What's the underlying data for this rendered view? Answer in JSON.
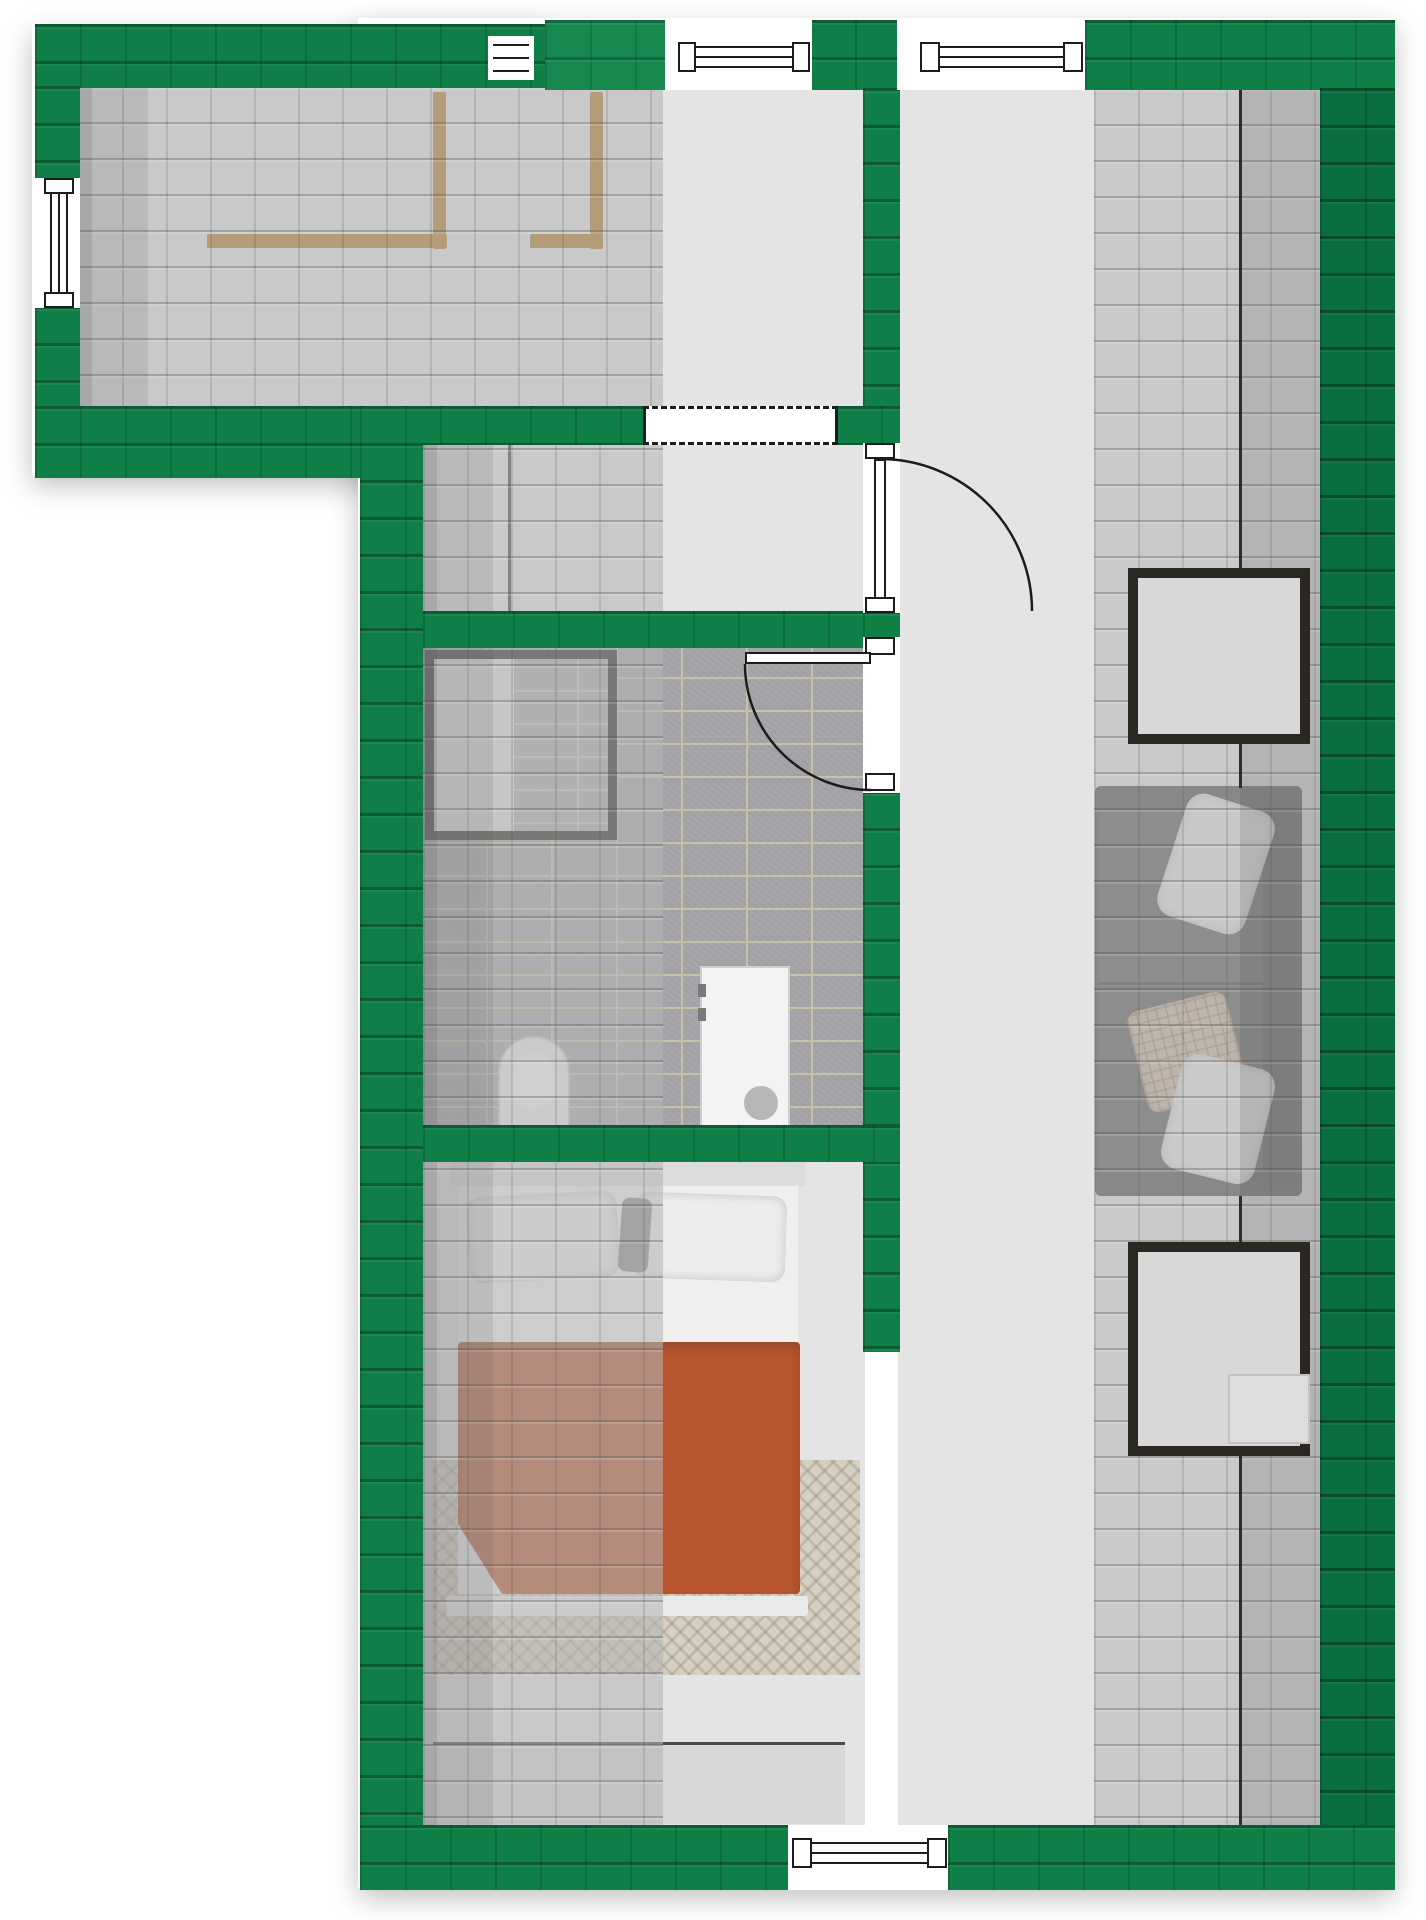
{
  "meta": {
    "type": "architectural-floor-plan",
    "view": "top-down attic storey with semi-transparent roof",
    "storey": "attic"
  },
  "palette": {
    "bg": "#ffffff",
    "roof-green": "#0f7f47",
    "roof-green-dark": "#0b6e3e",
    "roof-green-light": "#17894f",
    "floor": "#e4e4e4",
    "bath-tile": "#a2a2a6",
    "grout": "#c8c0a8",
    "wood": "#b07a28",
    "frame-dark": "#2b2824",
    "sofa": "#4b4b4b",
    "sofa-seat": "#565656",
    "blanket": "#b6552e",
    "rug": "#d6d0c2",
    "line": "#1c1c1c",
    "sideboard": "#d7d7d7"
  },
  "rooms": [
    {
      "name": "stair-landing-wing",
      "features": [
        "stairwell with wooden railing",
        "left wall window"
      ]
    },
    {
      "name": "upper-landing",
      "features": [
        "dashed interior opening"
      ]
    },
    {
      "name": "closet-room",
      "features": [
        "knee-wall line"
      ]
    },
    {
      "name": "bathroom",
      "features": [
        "shower enclosure",
        "toilet",
        "washbasin unit",
        "tiled floor"
      ]
    },
    {
      "name": "bedroom",
      "features": [
        "double bed with orange blanket",
        "rug",
        "sideboard"
      ]
    },
    {
      "name": "hallway-lounge",
      "features": [
        "sofa with pillows",
        "two roof skylights",
        "side table",
        "roof ridge line"
      ]
    }
  ],
  "windows": [
    {
      "name": "wing-left-window"
    },
    {
      "name": "small-top-window"
    },
    {
      "name": "top-window-left"
    },
    {
      "name": "top-window-right"
    },
    {
      "name": "bottom-window"
    },
    {
      "name": "dashed-interior-opening"
    }
  ],
  "doors": [
    {
      "name": "closet-to-hallway-door",
      "swing": "into hallway"
    },
    {
      "name": "bathroom-door",
      "swing": "into bathroom"
    }
  ],
  "furniture": [
    {
      "name": "stair-railing",
      "material": "wood"
    },
    {
      "name": "shower-enclosure"
    },
    {
      "name": "toilet"
    },
    {
      "name": "washbasin-unit"
    },
    {
      "name": "double-bed"
    },
    {
      "name": "bedroom-rug"
    },
    {
      "name": "sideboard"
    },
    {
      "name": "sofa"
    },
    {
      "name": "skylight-upper"
    },
    {
      "name": "skylight-lower"
    },
    {
      "name": "side-table"
    }
  ]
}
